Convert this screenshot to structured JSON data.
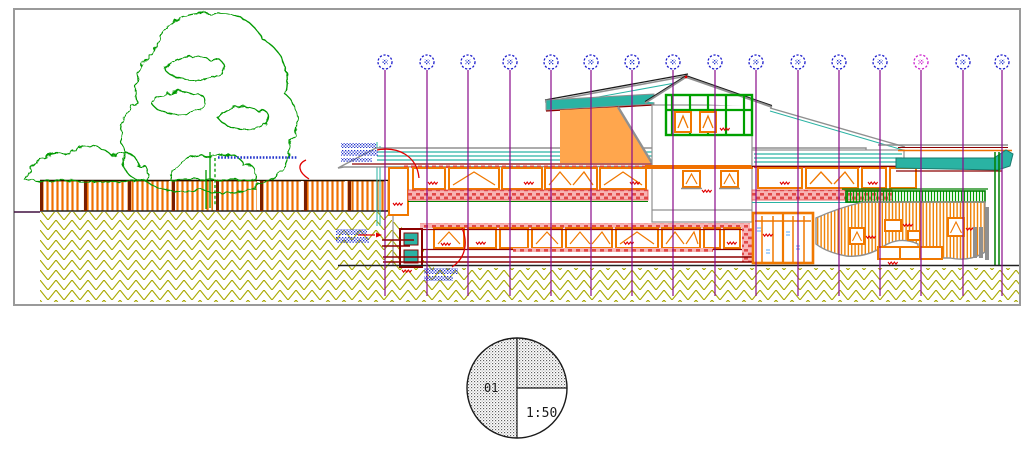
{
  "sheet": {
    "drawing_number": "01",
    "scale_label": "1:50"
  },
  "grid_markers": {
    "count": 16,
    "centers_x": [
      385,
      427,
      468,
      510,
      551,
      591,
      632,
      673,
      715,
      756,
      798,
      839,
      880,
      921,
      963,
      1002
    ],
    "center_y": 62,
    "default_color": "#1a1acc",
    "highlighted_marker_number": 14,
    "highlighted_color": "#cc22cc",
    "gridline_color": "#8a0b8a",
    "labels_legible": false
  },
  "annotations": {
    "note_blocks_count": 3,
    "legible": false,
    "text_color": "#2233cc",
    "leader_color": "#e00000"
  },
  "palette": {
    "frame_gray": "#9a9a9a",
    "vegetation_green": "#009900",
    "fence_orange": "#f07000",
    "ground_olive": "#a8a800",
    "roof_teal": "#2ab3a3",
    "window_orange": "#f07800",
    "slab_pink": "#f08080",
    "timber_green": "#00a000",
    "gable_orange": "#ffa64d",
    "dark_red": "#8b0000"
  }
}
